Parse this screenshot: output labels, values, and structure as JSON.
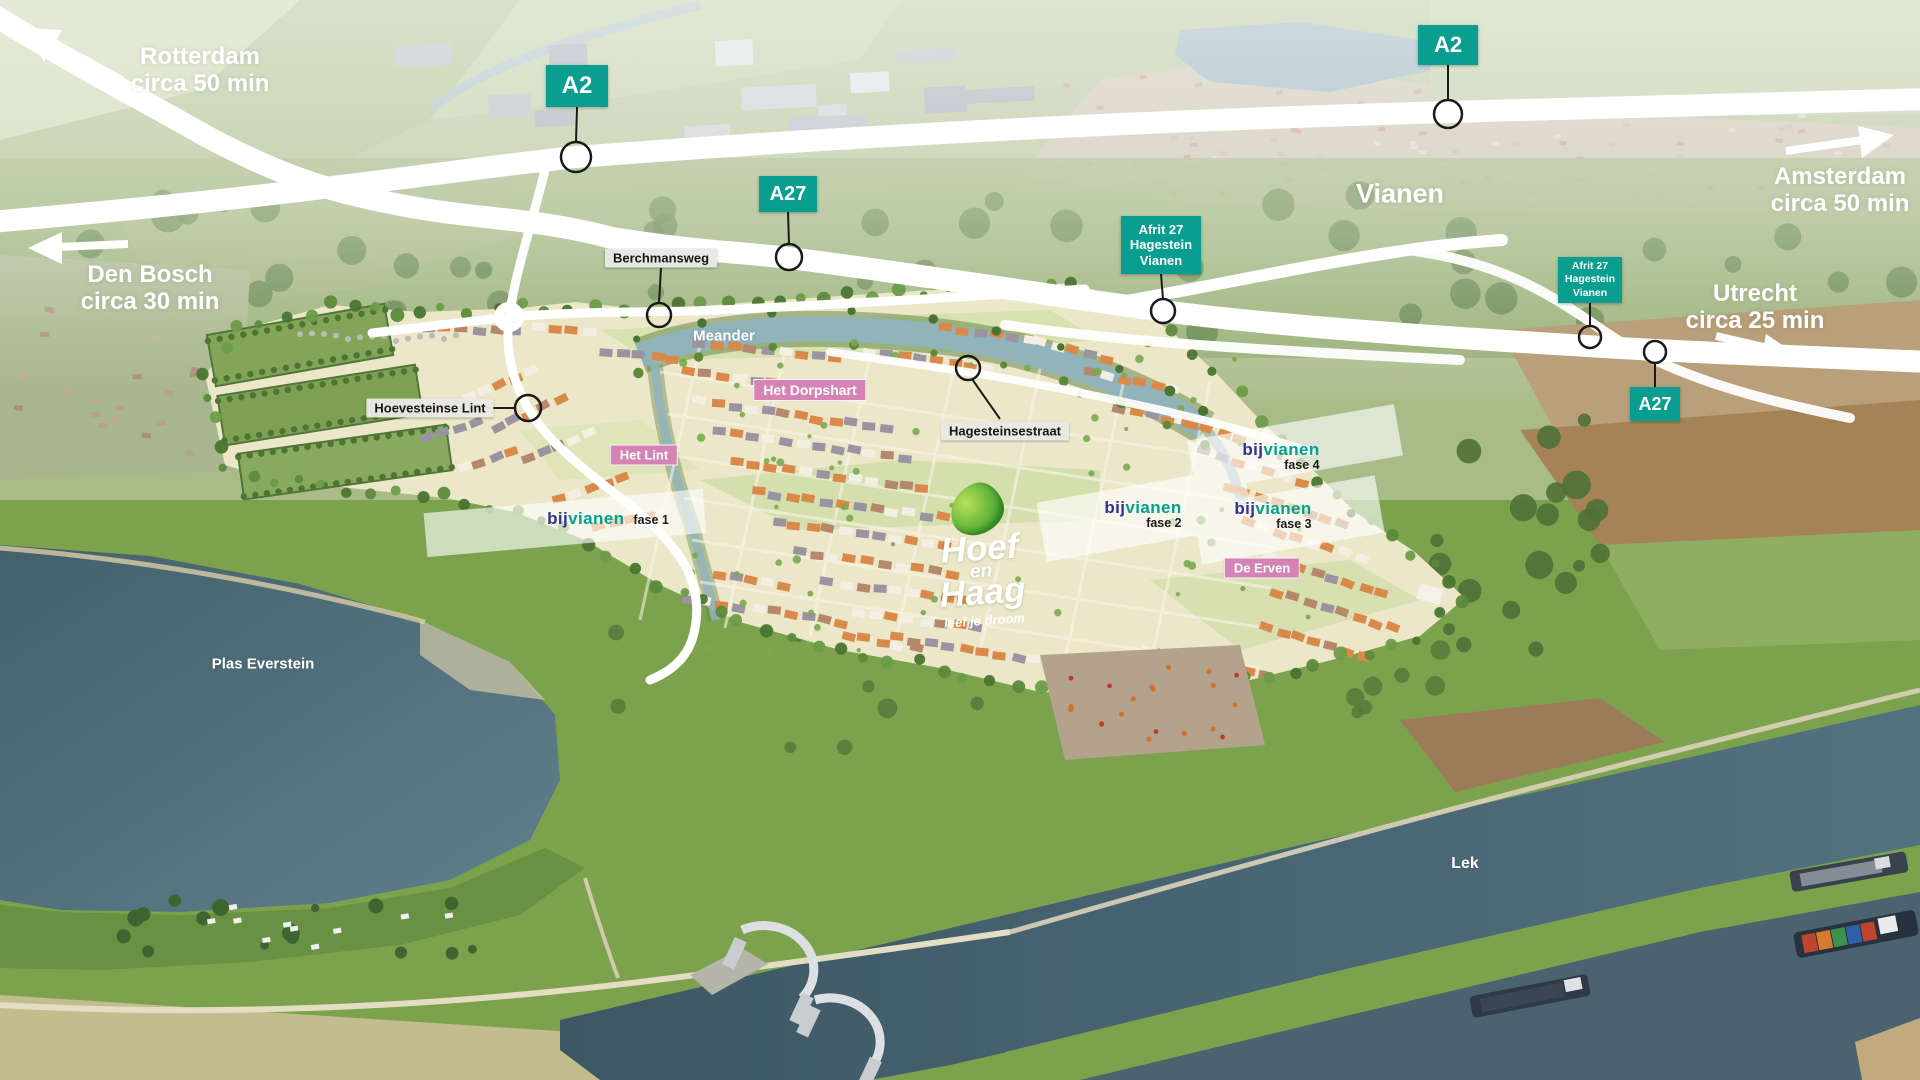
{
  "city_label": {
    "text": "Vianen"
  },
  "water_labels": {
    "meander": "Meander",
    "plas": "Plas Everstein",
    "lek": "Lek"
  },
  "destinations": {
    "rotterdam": {
      "city": "Rotterdam",
      "time": "circa 50 min"
    },
    "den_bosch": {
      "city": "Den Bosch",
      "time": "circa 30 min"
    },
    "amsterdam": {
      "city": "Amsterdam",
      "time": "circa 50 min"
    },
    "utrecht": {
      "city": "Utrecht",
      "time": "circa 25 min"
    }
  },
  "road_badges": {
    "a2_west": "A2",
    "a27_west": "A27",
    "a2_north": "A2",
    "a27_east": "A27"
  },
  "exit_badges": {
    "west": {
      "line1": "Afrit 27",
      "line2": "Hagestein",
      "line3": "Vianen"
    },
    "east": {
      "line1": "Afrit 27",
      "line2": "Hagestein",
      "line3": "Vianen"
    }
  },
  "street_labels": {
    "berchmansweg": "Berchmansweg",
    "hoevesteinse_lint": "Hoevesteinse Lint",
    "hagesteinsestraat": "Hagesteinsestraat"
  },
  "area_labels": {
    "het_dorpshart": "Het Dorpshart",
    "het_lint": "Het Lint",
    "de_erven": "De Erven"
  },
  "brand": {
    "bij": "bij",
    "vianen": "vianen"
  },
  "phases": {
    "fase1": "fase 1",
    "fase2": "fase 2",
    "fase3": "fase 3",
    "fase4": "fase 4"
  },
  "logo": {
    "line1": "Hoef",
    "line2": "en",
    "line3": "Haag",
    "tagline": "leef je droom"
  },
  "colors": {
    "teal": "#0a9e90",
    "pink": "#d583b5",
    "bblue": "#2f3193",
    "bteal": "#00a18e",
    "road_white": "#ffffff",
    "water_dark": "#46606c",
    "meander_water": "#90b4ba"
  }
}
